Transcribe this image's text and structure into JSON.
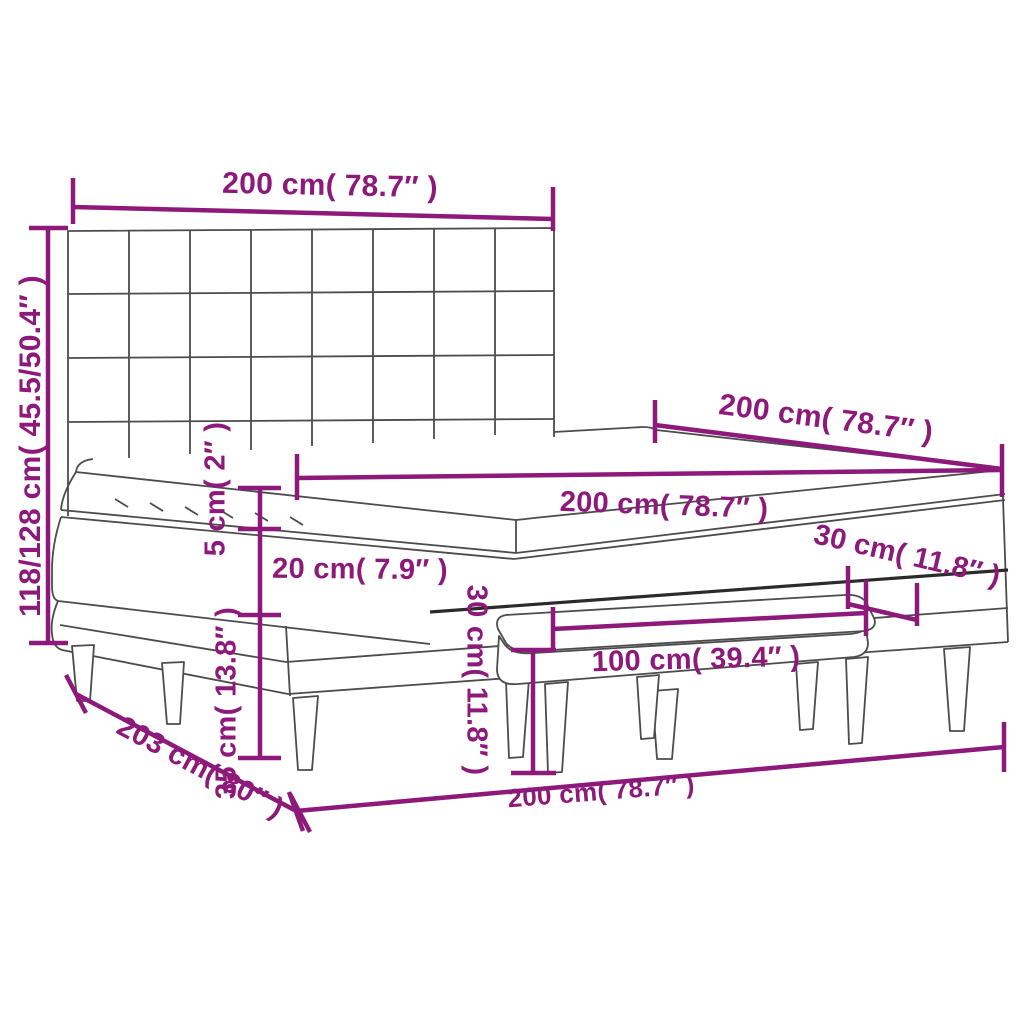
{
  "diagram": {
    "title": "box spring bed with tufted headboard, mattress, topper and bench - dimension diagram",
    "unit_system": "cm and inches",
    "colors": {
      "dimension_accent": "#8d1a7a",
      "outline_gray": "#4c4c4c",
      "outline_dark": "#2b2b2b",
      "background": "#ffffff"
    }
  },
  "dimensions": {
    "headboard_width": "200 cm( 78.7″ )",
    "total_height": "118/128 cm( 45.5/50.4″ )",
    "bed_depth": "200 cm( 78.7″ )",
    "mattress_width": "200 cm( 78.7″ )",
    "topper_thickness": "5 cm( 2″ )",
    "mattress_thickness": "20 cm( 7.9″ )",
    "base_height": "35 cm( 13.8″ )",
    "bench_width": "100 cm( 39.4″ )",
    "bench_depth": "30 cm( 11.8″ )",
    "bench_height": "30 cm( 11.8″ )",
    "frame_depth": "203 cm( 80″ )",
    "bed_width_bottom": "200 cm( 78.7″ )"
  }
}
